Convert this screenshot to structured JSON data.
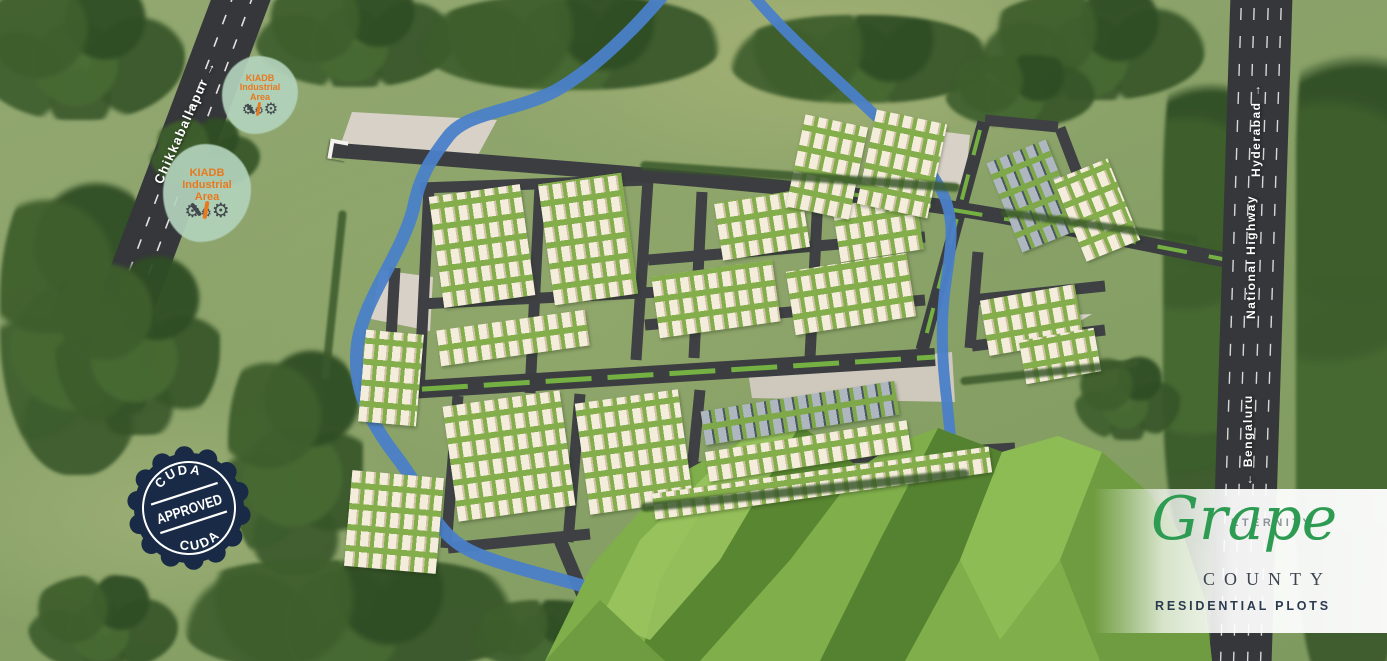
{
  "title": "Grape County residential plots master plan",
  "roads": {
    "chikkaballapur": {
      "label": "Chikkaballapur",
      "arrow": "→"
    },
    "hyderabad": {
      "label": "Hyderabad",
      "arrow": "→"
    },
    "national_highway": {
      "label": "National Highway"
    },
    "bengaluru": {
      "label": "Bengaluru",
      "arrow": "←"
    }
  },
  "markers": {
    "kiadb": {
      "line1": "KIADB",
      "line2": "Industrial",
      "line3": "Area",
      "gear_icon": "⚙"
    },
    "stamp": {
      "arc_top": "CUDA",
      "center": "APPROVED",
      "arc_bottom": "CUDA"
    }
  },
  "logo": {
    "brand": "ETERNITY",
    "name": "Grape",
    "subname": "COUNTY",
    "tagline": "RESIDENTIAL PLOTS"
  },
  "colors": {
    "grass": "#8aa066",
    "road": "#3b3d40",
    "river": "#4a80c8",
    "lawn": "#7cb34a",
    "house": "#f3ecdc",
    "stamp_navy": "#182a45",
    "kiadb_orange": "#e8791e",
    "kiadb_blob": "#b2d2bc",
    "logo_green": "#2e9b52",
    "logo_dark": "#2b3b4f"
  }
}
